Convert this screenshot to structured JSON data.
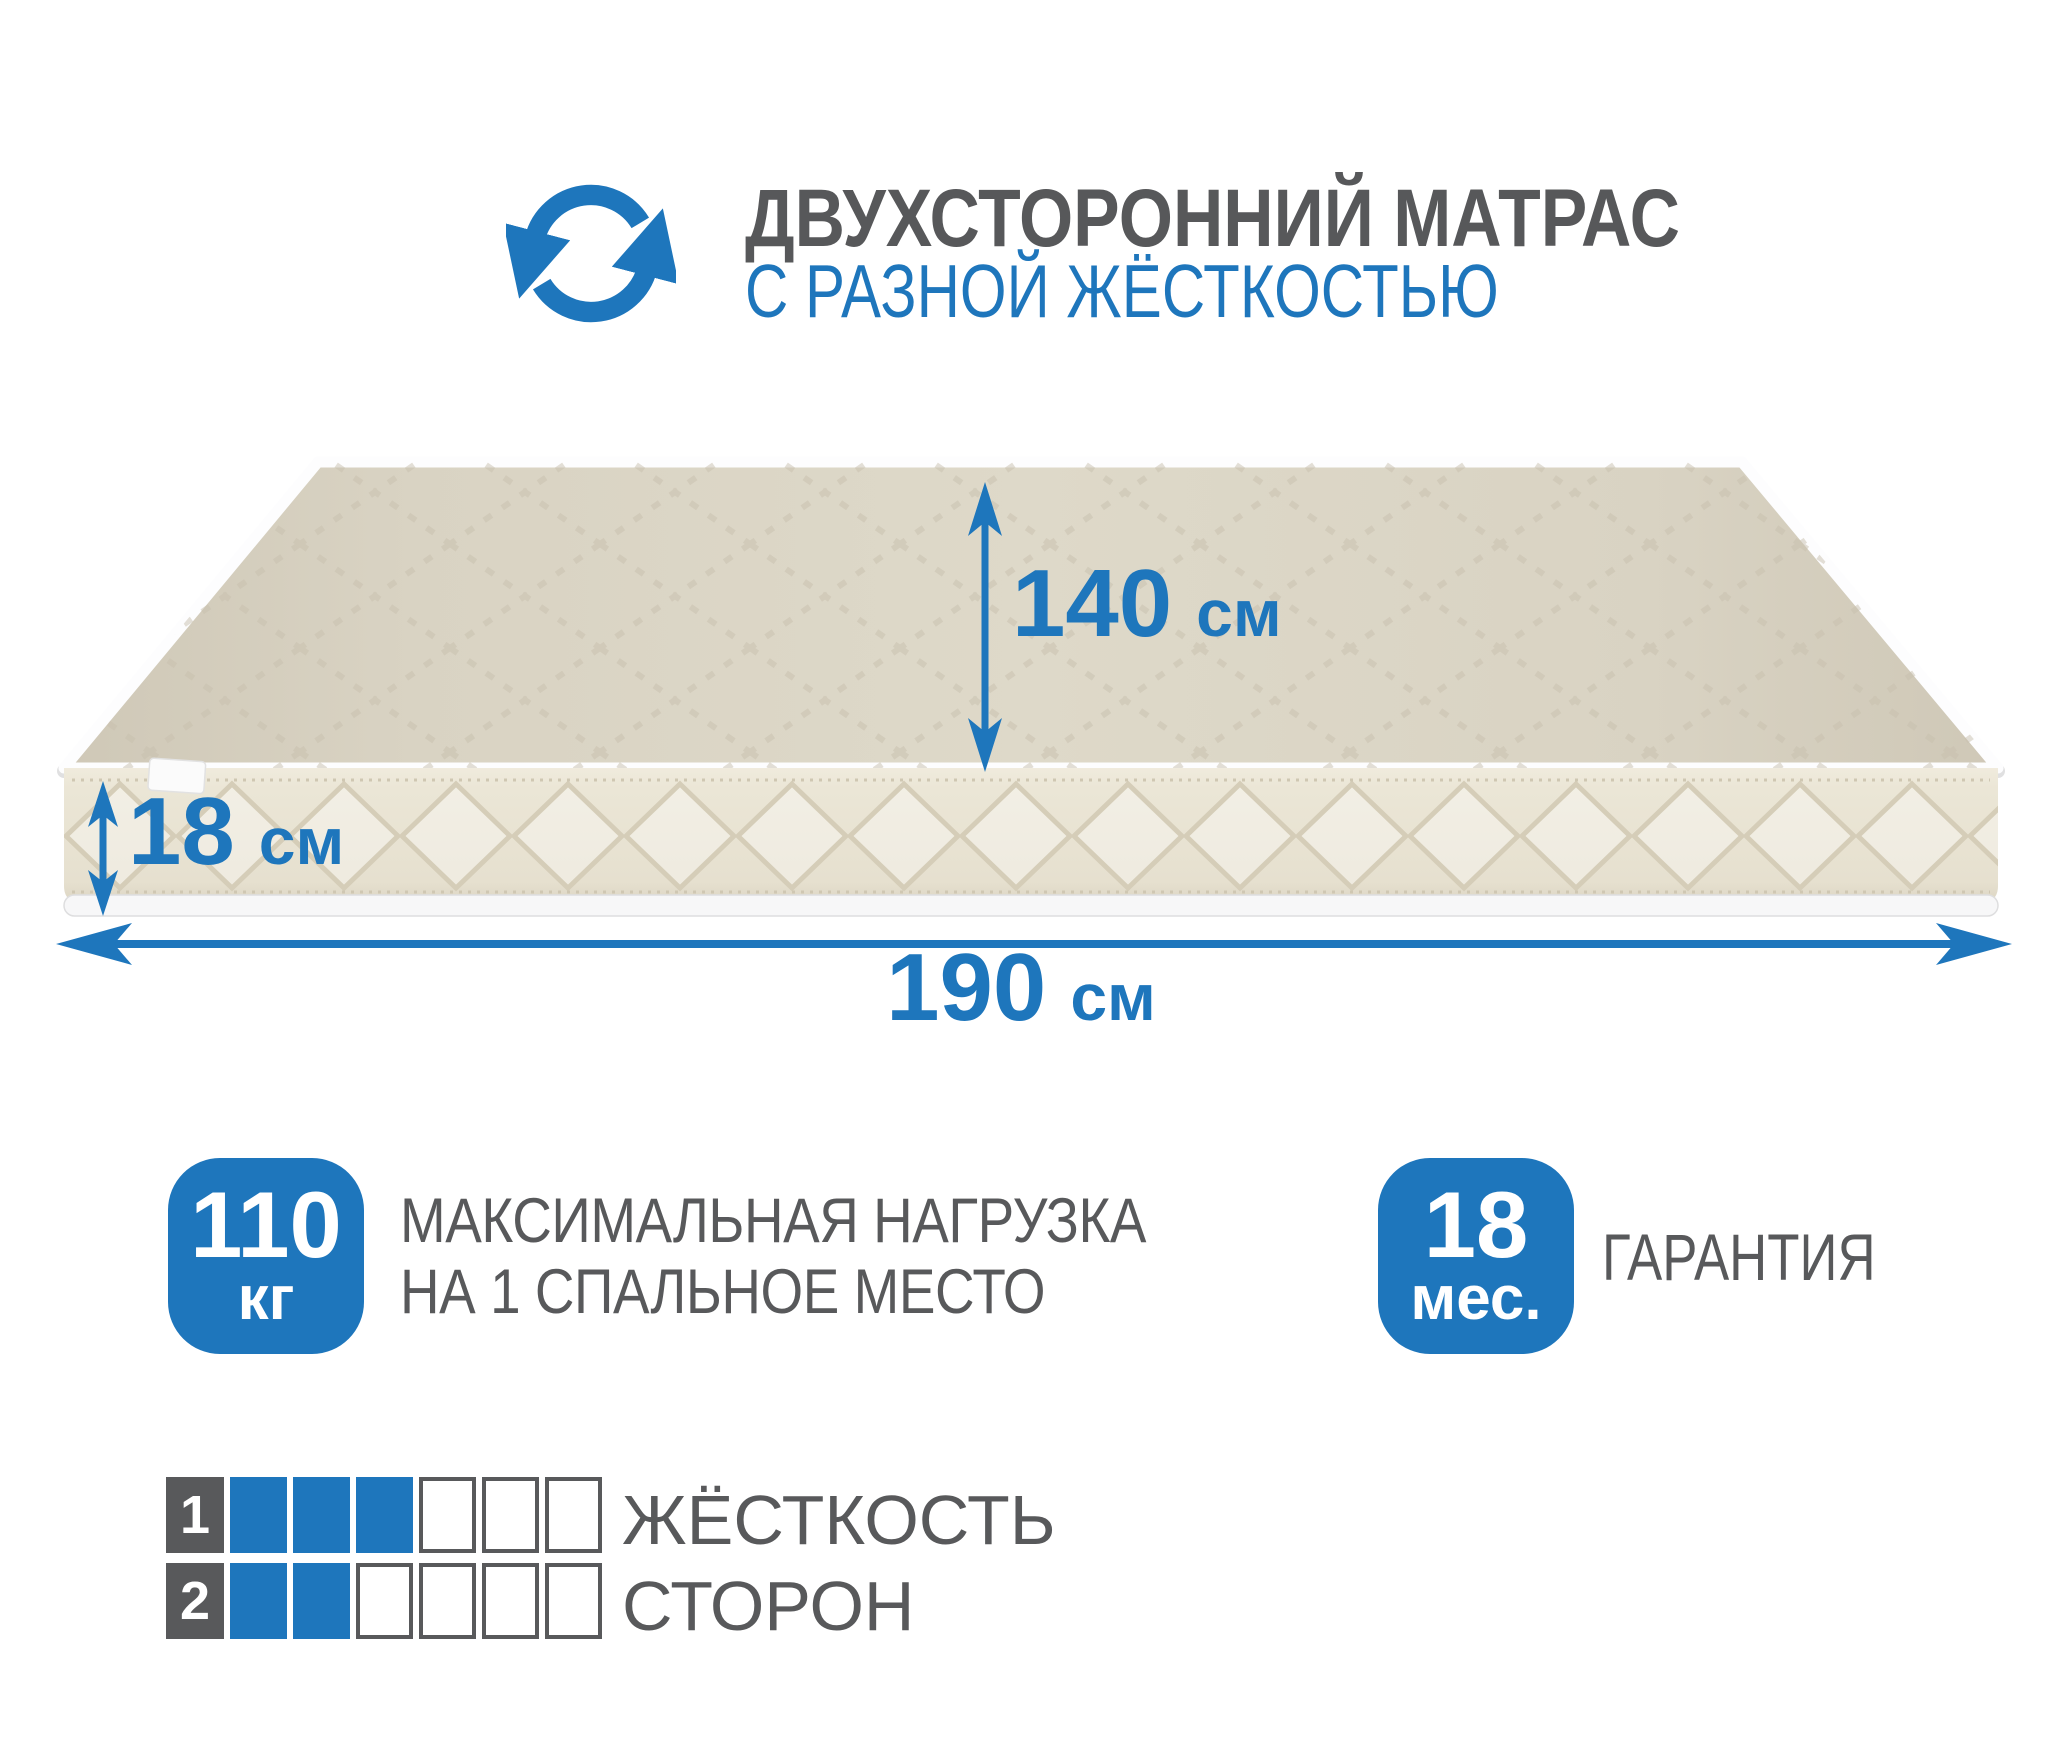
{
  "header": {
    "title": "ДВУХСТОРОННИЙ МАТРАС",
    "subtitle": "С РАЗНОЙ ЖЁСТКОСТЬЮ",
    "icon": "rotate-arrows-icon"
  },
  "dimensions": {
    "top_width": {
      "value": "140",
      "unit": "см"
    },
    "thickness": {
      "value": "18",
      "unit": "см"
    },
    "length": {
      "value": "190",
      "unit": "см"
    }
  },
  "badges": {
    "max_load": {
      "value": "110",
      "unit": "кг",
      "label_line1": "МАКСИМАЛЬНАЯ НАГРУЗКА",
      "label_line2": "НА 1 СПАЛЬНОЕ МЕСТО"
    },
    "warranty": {
      "value": "18",
      "unit": "мес.",
      "label": "ГАРАНТИЯ"
    }
  },
  "firmness": {
    "label_line1": "ЖЁСТКОСТЬ",
    "label_line2": "СТОРОН",
    "scale_max": 6,
    "sides": [
      {
        "number": "1",
        "filled": 3
      },
      {
        "number": "2",
        "filled": 2
      }
    ]
  },
  "colors": {
    "accent": "#1e76bc",
    "title_gray": "#57585a",
    "label_gray": "#58595b"
  }
}
